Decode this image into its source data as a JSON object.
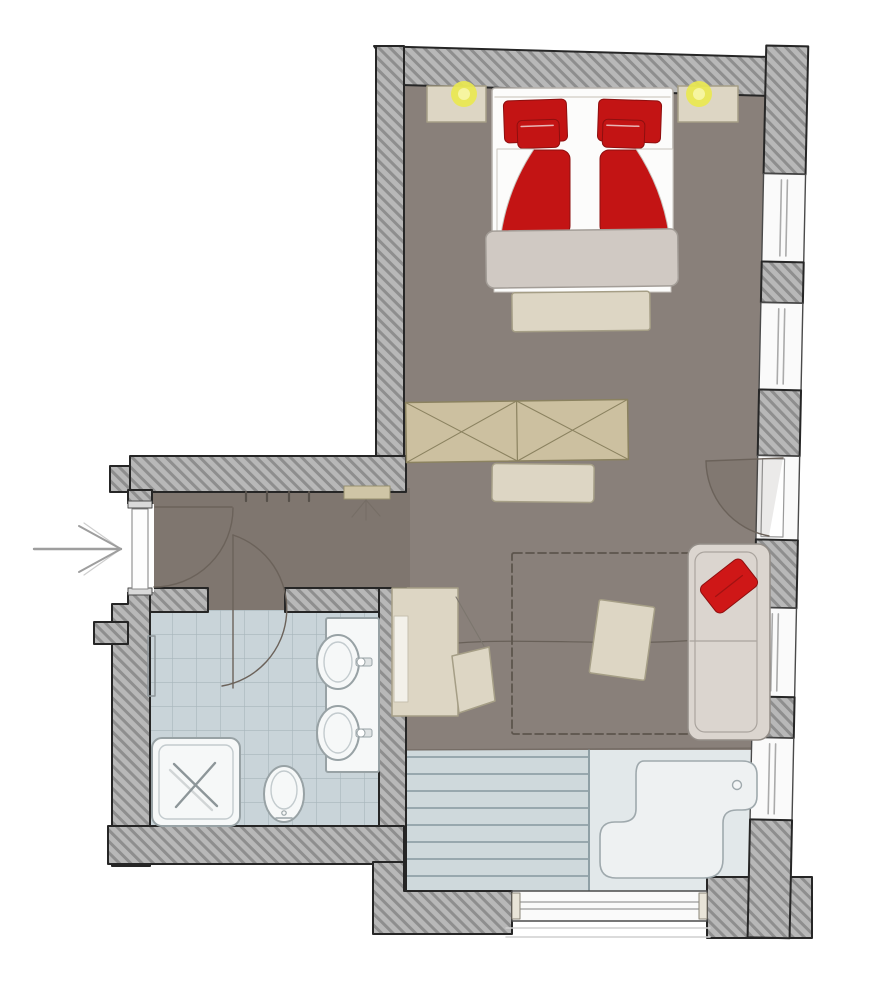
{
  "colors": {
    "paper": "#ffffff",
    "outline": "#262626",
    "wall-base": "#b8b8b8",
    "wall-stripe": "#8e8e8e",
    "floor": "#89807a",
    "hallway-floor": "#7f766f",
    "tile": "#c9d4d9",
    "tile-grid": "#a3b2b8",
    "fixture-white": "#f6f8f8",
    "fixture-stroke": "#98a2a5",
    "fixture-inner": "#c3cbce",
    "deck": "#cfd9dc",
    "deck-line": "#8fa0a6",
    "tub-zone": "#e2e8ea",
    "tub-fill": "#eef1f2",
    "tub-stroke": "#9fa9ad",
    "window-fill": "#fafafa",
    "window-frame": "#4a4a4a",
    "mullion": "#aaaaaa",
    "beige": "#ddd6c4",
    "beige-stroke": "#a59e86",
    "wardrobe": "#ccc0a0",
    "wardrobe-stroke": "#8b8260",
    "blanket": "#d0c9c3",
    "blanket-stroke": "#a39d97",
    "red": "#c31414",
    "red-dark": "#8e0f0f",
    "cushion-red": "#cf1717",
    "sofa": "#dbd5cf",
    "sofa-stroke": "#938d87",
    "lamp": "#eae94f",
    "lamp-core": "#f6f5a0",
    "door-stroke": "#6b625a",
    "sketch": "#6f675f",
    "arrow": "#9e9e9e",
    "mattress": "#fcfcfb"
  },
  "plan": {
    "rooms": [
      {
        "id": "bedroom",
        "furniture": [
          "double-bed",
          "red-pillows",
          "red-duvets",
          "foot-blanket",
          "bench",
          "nightstand-left",
          "nightstand-right",
          "bedside-lamp-left",
          "bedside-lamp-right",
          "wardrobe",
          "sideboard"
        ]
      },
      {
        "id": "entry-hall",
        "features": [
          "entry-arrow",
          "entry-door",
          "coat-hooks",
          "wall-shelf"
        ]
      },
      {
        "id": "bathroom",
        "fixtures": [
          "shower",
          "toilet",
          "washbasin-1",
          "washbasin-2",
          "vanity-counter",
          "towel-rail",
          "bathroom-door"
        ]
      },
      {
        "id": "living-area",
        "furniture": [
          "desk",
          "desk-chair",
          "rug",
          "side-table",
          "sofa",
          "red-cushion"
        ],
        "features": [
          "balcony-door"
        ]
      },
      {
        "id": "terrace",
        "features": [
          "wood-deck",
          "outdoor-tub",
          "panorama-window"
        ]
      }
    ],
    "counts": {
      "windows": 5,
      "doors": 3,
      "lamps": 2
    }
  }
}
